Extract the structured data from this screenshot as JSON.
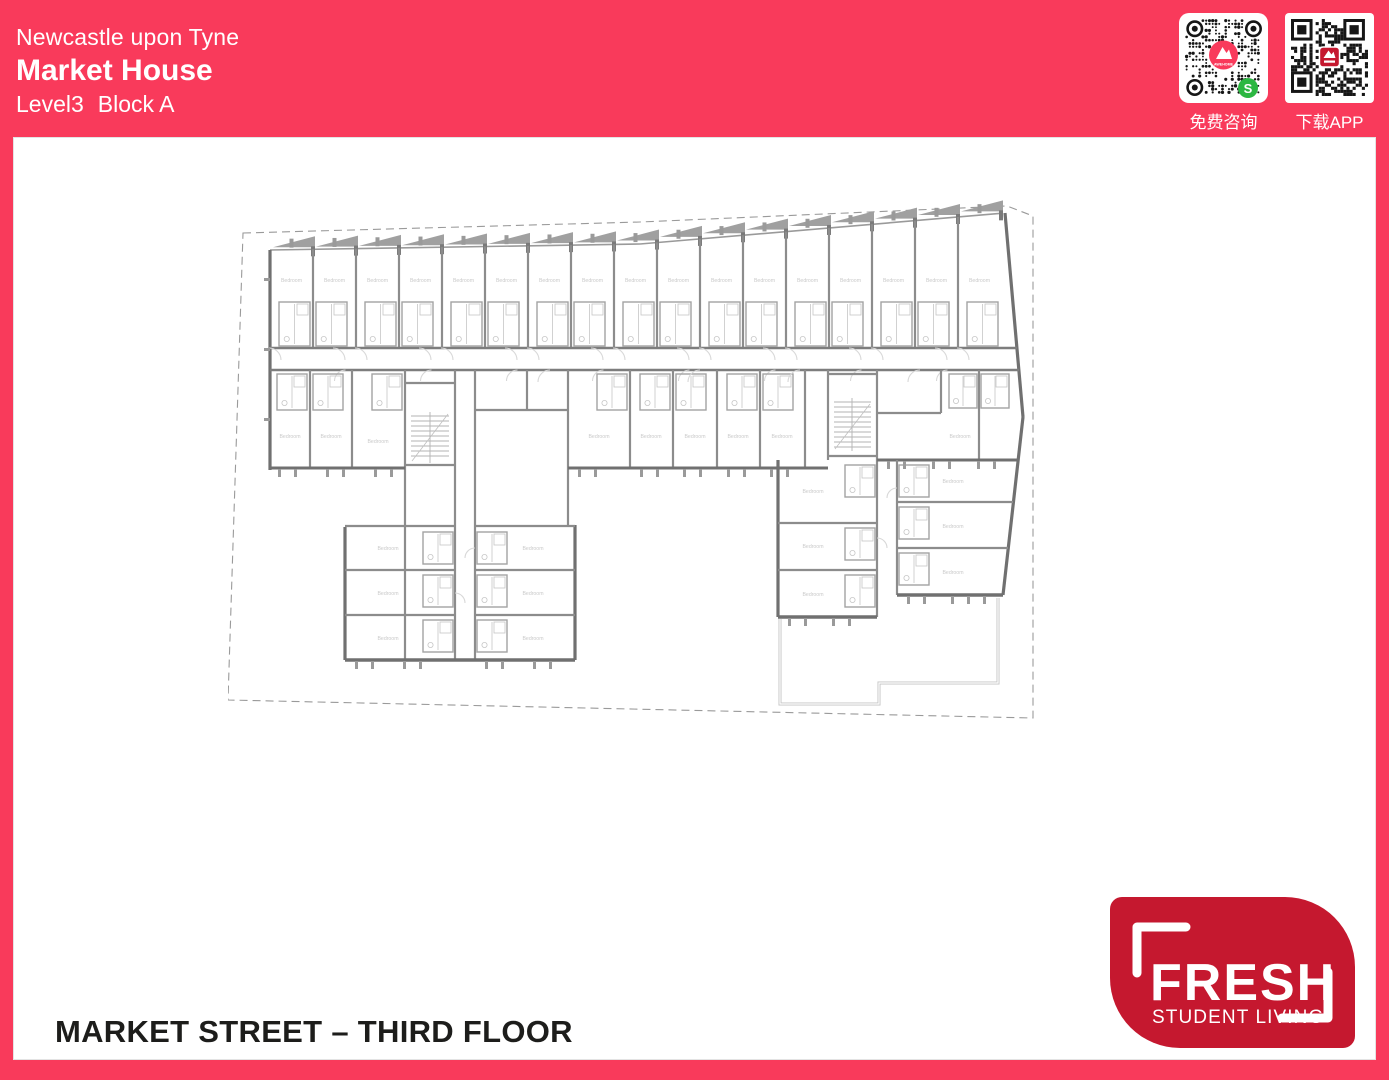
{
  "colors": {
    "accent": "#f93a5b",
    "logo_red": "#c5182f",
    "wechat_green": "#2cb742",
    "ink": "#1d1d1b",
    "wall_gray": "#8c8c8c"
  },
  "header": {
    "city": "Newcastle upon Tyne",
    "building": "Market House",
    "level": "Level3",
    "block": "Block A"
  },
  "qr_panel": {
    "consult_label": "免费咨询",
    "consult_brand": "AWEHOME",
    "app_label": "下载APP"
  },
  "plan": {
    "room_label": "Bedroom"
  },
  "footer": {
    "caption": "MARKET STREET – THIRD FLOOR"
  },
  "logo": {
    "brand": "FRESH",
    "tagline": "STUDENT LIVING"
  }
}
